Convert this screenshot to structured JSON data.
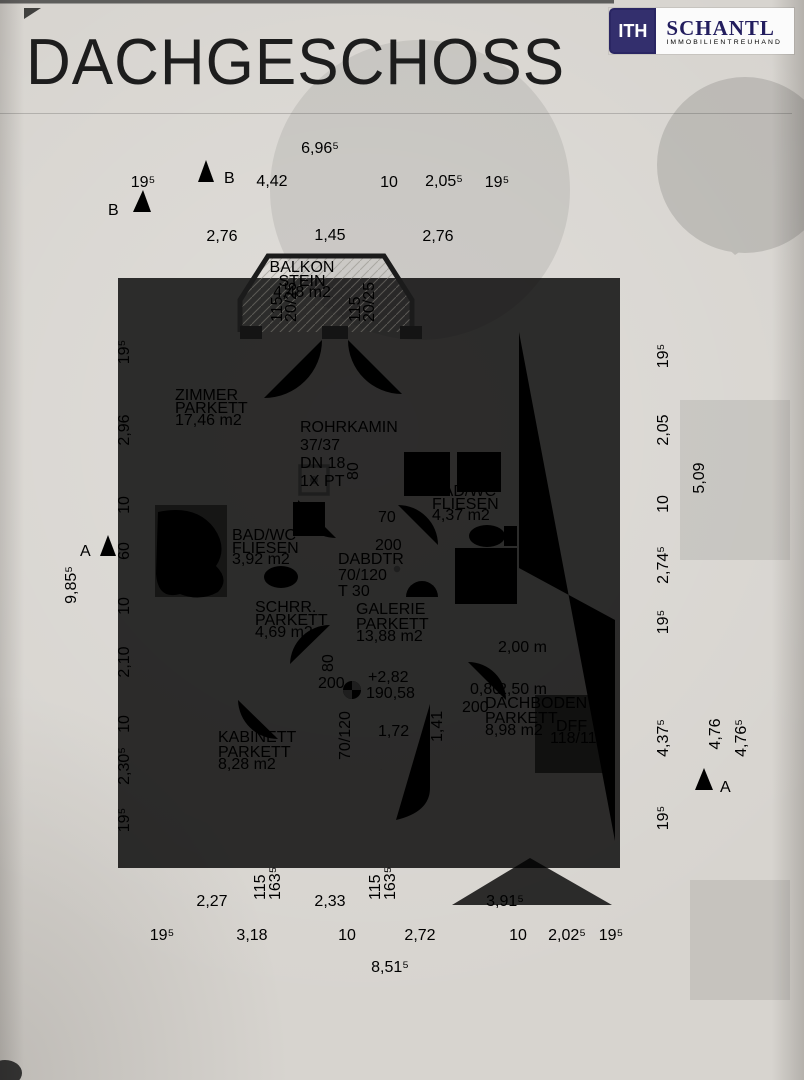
{
  "header": {
    "title": "DACHGESCHOSS"
  },
  "logo": {
    "mark": "ITH",
    "name": "SCHANTL",
    "tagline": "IMMOBILIENTREUHAND",
    "brand_color": "#332f6d"
  },
  "rooms": {
    "balkon": {
      "name": "BALKON",
      "finish": "STEIN",
      "area": "4,48 m2"
    },
    "zimmer": {
      "name": "ZIMMER",
      "finish": "PARKETT",
      "area": "17,46 m2"
    },
    "bad_right": {
      "name": "BAD/WC",
      "finish": "FLIESEN",
      "area": "4,37 m2"
    },
    "bad_left": {
      "name": "BAD/WC",
      "finish": "FLIESEN",
      "area": "3,92 m2"
    },
    "schrank": {
      "name": "SCHRR.",
      "finish": "PARKETT",
      "area": "4,69 m2"
    },
    "galerie": {
      "name": "GALERIE",
      "finish": "PARKETT",
      "area": "13,88 m2"
    },
    "kabinett": {
      "name": "KABINETT",
      "finish": "PARKETT",
      "area": "8,28 m2"
    },
    "dachboden": {
      "name": "DACHBODEN",
      "finish": "PARKETT",
      "area": "8,98 m2"
    }
  },
  "annotations": {
    "rohrkamin": {
      "l1": "ROHRKAMIN",
      "l2": "37/37",
      "l3": "DN 18",
      "l4": "1X PT"
    },
    "dff_left": {
      "l1": "DFF",
      "l2": "78/118"
    },
    "dff_mid": {
      "l1": "DFF",
      "l2": "78/118"
    },
    "dff_dachboden": {
      "l1": "DFF",
      "l2": "118/118"
    },
    "dabdtr": {
      "l1": "DABDTR",
      "l2": "70/120",
      "l3": "T 30"
    },
    "level": {
      "l1": "+2,82",
      "l2": "190,58"
    },
    "stair": {
      "run": "1,72",
      "rise": "1,41",
      "size": "70/120"
    },
    "dachboden_dims": {
      "a": "2,00 m",
      "b": "0,80",
      "c": "2,50 m",
      "d": "200"
    },
    "mid_dims": {
      "a": "80",
      "b": "70",
      "c": "200",
      "d": "80",
      "e": "200"
    },
    "sections": {
      "b1": "B",
      "b2": "B",
      "a1": "A",
      "a2": "A"
    }
  },
  "dims": {
    "top_total": "6,96⁵",
    "top_row": [
      "19⁵",
      "4,42",
      "10",
      "2,05⁵",
      "19⁵"
    ],
    "top_row2": [
      "2,76",
      "1,45",
      "2,76"
    ],
    "left_outer": "9,85⁵",
    "left_row": [
      "19⁵",
      "2,96",
      "10",
      "60",
      "10",
      "2,10",
      "10",
      "2,30⁵",
      "19⁵"
    ],
    "right_row": [
      "19⁵",
      "2,05",
      "10",
      "2,74⁵",
      "19⁵",
      "4,37⁵",
      "19⁵"
    ],
    "right_outer": [
      "5,09",
      "4,76",
      "4,76⁵"
    ],
    "bottom_row1": [
      "2,27",
      "2,33",
      "3,91⁵"
    ],
    "bottom_row2": [
      "19⁵",
      "3,18",
      "10",
      "2,72",
      "10",
      "2,02⁵",
      "19⁵"
    ],
    "bottom_total": "8,51⁵",
    "pier_labels": [
      "115",
      "20/25",
      "115",
      "20/25"
    ],
    "sill_labels": [
      "115",
      "163⁵",
      "115",
      "163⁵"
    ]
  }
}
